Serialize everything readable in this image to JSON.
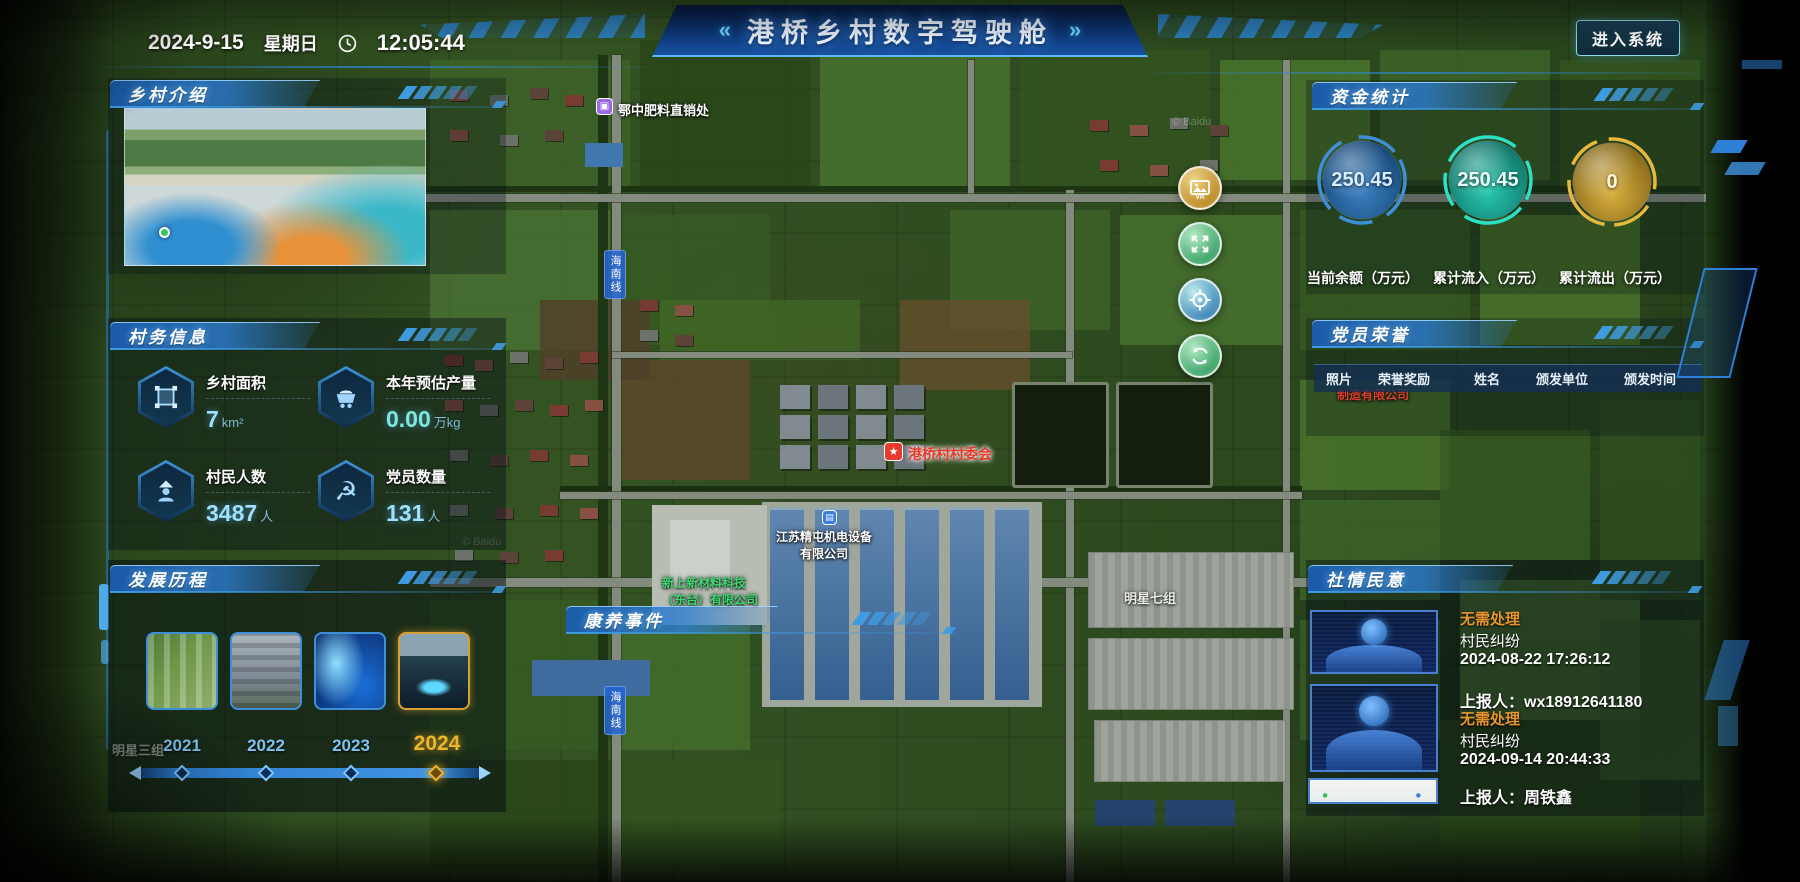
{
  "header": {
    "title": "港桥乡村数字驾驶舱",
    "left_ornament": "«",
    "right_ornament": "»",
    "date": "2024-9-15",
    "weekday": "星期日",
    "time": "12:05:44",
    "enter_button": "进入系统"
  },
  "intro": {
    "title": "乡村介绍"
  },
  "affairs": {
    "title": "村务信息",
    "stats": [
      {
        "icon": "area-icon",
        "label": "乡村面积",
        "value": "7",
        "unit": "km²"
      },
      {
        "icon": "harvest-cart-icon",
        "label": "本年预估产量",
        "value": "0.00",
        "unit": "万kg"
      },
      {
        "icon": "villagers-icon",
        "label": "村民人数",
        "value": "3487",
        "unit": "人"
      },
      {
        "icon": "party-emblem-icon",
        "label": "党员数量",
        "value": "131",
        "unit": "人"
      }
    ]
  },
  "history": {
    "title": "发展历程",
    "years": [
      "2021",
      "2022",
      "2023",
      "2024"
    ],
    "active_year": "2024"
  },
  "funds": {
    "title": "资金统计",
    "gauges": [
      {
        "value": "250.45",
        "label": "当前余额（万元）",
        "color": "#4da0e8"
      },
      {
        "value": "250.45",
        "label": "累计流入（万元）",
        "color": "#2ce0c4"
      },
      {
        "value": "0",
        "label": "累计流出（万元）",
        "color": "#e0aa30"
      }
    ]
  },
  "honors": {
    "title": "党员荣誉",
    "columns": [
      "照片",
      "荣誉奖励",
      "姓名",
      "颁发单位",
      "颁发时间"
    ]
  },
  "sentiment": {
    "title": "社情民意",
    "items": [
      {
        "status": "无需处理",
        "type": "村民纠纷",
        "time": "2024-08-22 17:26:12",
        "reporter": "上报人：wx18912641180"
      },
      {
        "status": "无需处理",
        "type": "村民纠纷",
        "time": "2024-09-14 20:44:33",
        "reporter": "上报人：周铁鑫"
      }
    ]
  },
  "health_events": {
    "title": "康养事件"
  },
  "map": {
    "watermark": "© Baidu",
    "markers": [
      {
        "name": "鄂中肥料直销处"
      },
      {
        "name": "港桥村村委会"
      },
      {
        "name": "江苏精屯机电设备",
        "name2": "有限公司"
      },
      {
        "name": "新上新材料科技",
        "name2": "（东台）有限公司"
      },
      {
        "name": "制造有限公司"
      }
    ],
    "road_label": "海南线",
    "area_labels": [
      "明星七组",
      "明星三组"
    ]
  }
}
